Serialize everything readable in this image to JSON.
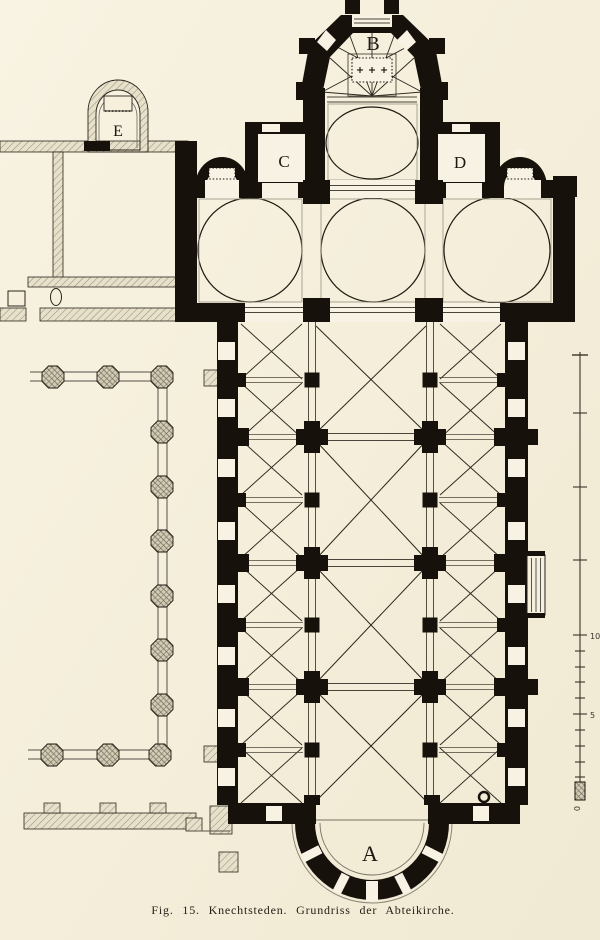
{
  "figure": {
    "caption": "Fig. 15. Knechtsteden. Grundriss der Abteikirche.",
    "labels": {
      "west_apse": "A",
      "east_apse": "B",
      "north_chapel_left": "C",
      "north_chapel_right": "D",
      "outer_chapel": "E"
    },
    "scale_bar": {
      "tick_labels": [
        "10",
        "5",
        "0"
      ]
    },
    "colors": {
      "paper": "#f5efdc",
      "ink": "#16120b"
    }
  }
}
